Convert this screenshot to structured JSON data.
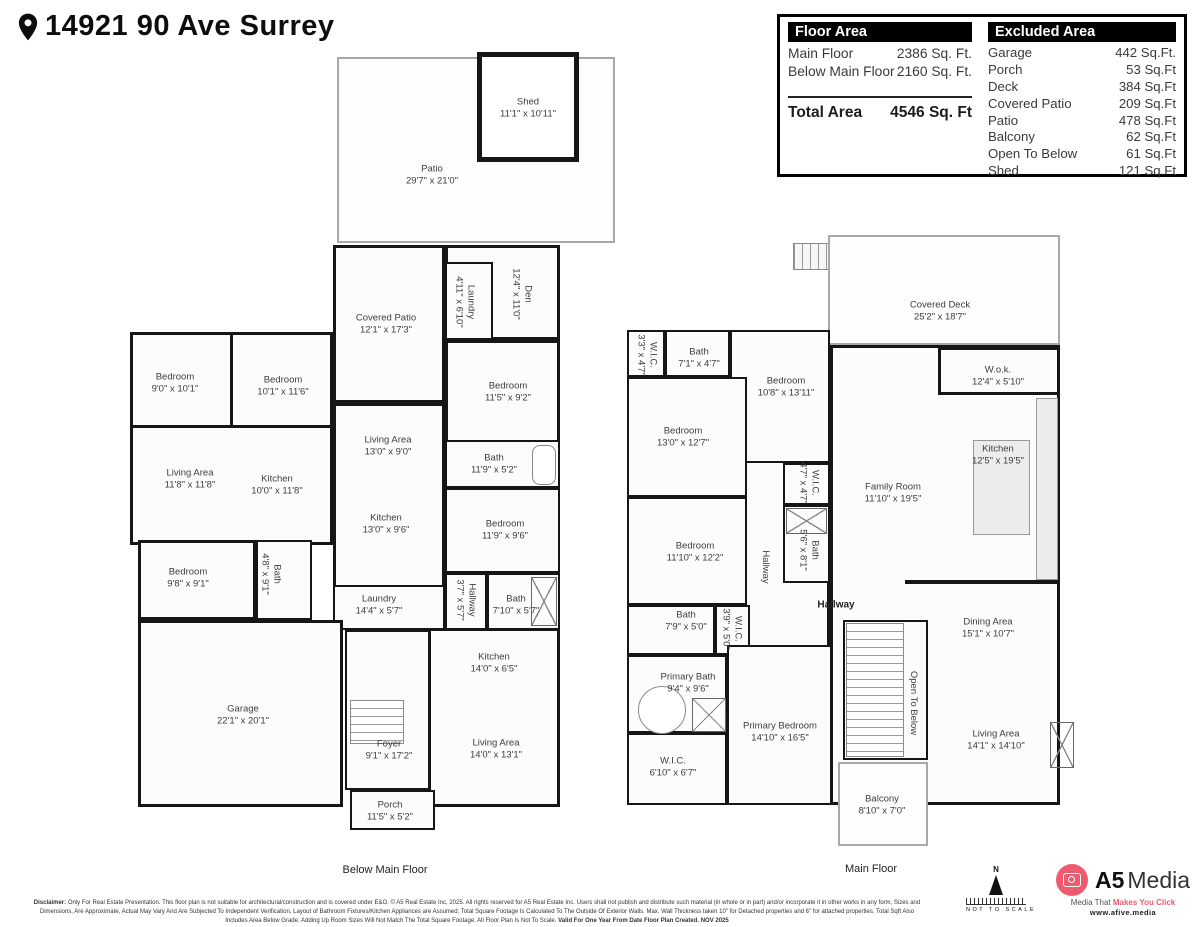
{
  "header": {
    "title": "14921 90 Ave Surrey"
  },
  "floor_area_table": {
    "title": "Floor Area",
    "rows": [
      {
        "label": "Main Floor",
        "value": "2386 Sq. Ft."
      },
      {
        "label": "Below Main Floor",
        "value": "2160 Sq. Ft."
      }
    ],
    "total_label": "Total Area",
    "total_value": "4546 Sq. Ft"
  },
  "excluded_area_table": {
    "title": "Excluded Area",
    "rows": [
      {
        "label": "Garage",
        "value": "442 Sq.Ft."
      },
      {
        "label": "Porch",
        "value": "53 Sq.Ft"
      },
      {
        "label": "Deck",
        "value": "384 Sq.Ft"
      },
      {
        "label": "Covered Patio",
        "value": "209 Sq.Ft"
      },
      {
        "label": "Patio",
        "value": "478 Sq.Ft"
      },
      {
        "label": "Balcony",
        "value": "62 Sq.Ft"
      },
      {
        "label": "Open To Below",
        "value": "61 Sq.Ft"
      },
      {
        "label": "Shed",
        "value": "121 Sq.Ft"
      }
    ]
  },
  "plans": {
    "below": {
      "caption": "Below Main Floor",
      "rooms": [
        {
          "name": "Shed",
          "dims": "11'1\" x 10'11\""
        },
        {
          "name": "Patio",
          "dims": "29'7\" x 21'0\""
        },
        {
          "name": "Covered Patio",
          "dims": "12'1\" x 17'3\""
        },
        {
          "name": "Laundry",
          "dims": "4'11\" x 6'10\""
        },
        {
          "name": "Den",
          "dims": "12'4\" x 11'0\""
        },
        {
          "name": "Bedroom",
          "dims": "9'0\" x 10'1\""
        },
        {
          "name": "Bedroom",
          "dims": "10'1\" x 11'6\""
        },
        {
          "name": "Bedroom",
          "dims": "11'5\" x 9'2\""
        },
        {
          "name": "Living Area",
          "dims": "13'0\" x 9'0\""
        },
        {
          "name": "Bath",
          "dims": "11'9\" x 5'2\""
        },
        {
          "name": "Living Area",
          "dims": "11'8\" x 11'8\""
        },
        {
          "name": "Kitchen",
          "dims": "10'0\" x 11'8\""
        },
        {
          "name": "Kitchen",
          "dims": "13'0\" x 9'6\""
        },
        {
          "name": "Bedroom",
          "dims": "11'9\" x 9'6\""
        },
        {
          "name": "Bedroom",
          "dims": "9'8\" x 9'1\""
        },
        {
          "name": "Bath",
          "dims": "4'8\" x 9'1\""
        },
        {
          "name": "Laundry",
          "dims": "14'4\" x 5'7\""
        },
        {
          "name": "Hallway",
          "dims": "3'7\" x 5'7\""
        },
        {
          "name": "Bath",
          "dims": "7'10\" x 5'7\""
        },
        {
          "name": "Kitchen",
          "dims": "14'0\" x 6'5\""
        },
        {
          "name": "Garage",
          "dims": "22'1\" x 20'1\""
        },
        {
          "name": "Foyer",
          "dims": "9'1\" x 17'2\""
        },
        {
          "name": "Living Area",
          "dims": "14'0\" x 13'1\""
        },
        {
          "name": "Porch",
          "dims": "11'5\" x 5'2\""
        }
      ]
    },
    "main": {
      "caption": "Main Floor",
      "rooms": [
        {
          "name": "Covered Deck",
          "dims": "25'2\" x 18'7\""
        },
        {
          "name": "W.I.C.",
          "dims": "3'3\" x 4'7\""
        },
        {
          "name": "Bath",
          "dims": "7'1\" x 4'7\""
        },
        {
          "name": "Bedroom",
          "dims": "10'8\" x 13'11\""
        },
        {
          "name": "W.o.k.",
          "dims": "12'4\" x 5'10\""
        },
        {
          "name": "Bedroom",
          "dims": "13'0\" x 12'7\""
        },
        {
          "name": "Kitchen",
          "dims": "12'5\" x 19'5\""
        },
        {
          "name": "Family Room",
          "dims": "11'10\" x 19'5\""
        },
        {
          "name": "W.I.C.",
          "dims": "4'7\" x 4'7\""
        },
        {
          "name": "Bath",
          "dims": "5'6\" x 8'1\""
        },
        {
          "name": "Bedroom",
          "dims": "11'10\" x 12'2\""
        },
        {
          "name": "Hallway",
          "dims": ""
        },
        {
          "name": "Hallway",
          "dims": ""
        },
        {
          "name": "Bath",
          "dims": "7'9\" x 5'0\""
        },
        {
          "name": "W.I.C.",
          "dims": "3'9\" x 5'0\""
        },
        {
          "name": "Dining Area",
          "dims": "15'1\" x 10'7\""
        },
        {
          "name": "Primary Bath",
          "dims": "9'4\" x 9'6\""
        },
        {
          "name": "Open To Below",
          "dims": ""
        },
        {
          "name": "Primary Bedroom",
          "dims": "14'10\" x 16'5\""
        },
        {
          "name": "Living Area",
          "dims": "14'1\" x 14'10\""
        },
        {
          "name": "W.I.C.",
          "dims": "6'10\" x 6'7\""
        },
        {
          "name": "Balcony",
          "dims": "8'10\" x 7'0\""
        }
      ]
    }
  },
  "footer": {
    "disclaimer": {
      "label": "Disclaimer:",
      "line1": "Only For Real Estate Presentation. This floor plan is not suitable for architectural/construction and is covered under E&O. © A5 Real Estate Inc, 2025. All rights reserved for A5 Real Estate Inc. Users shall not publish and distribute such material (in whole or in part) and/or incorporate it in other works in any form, Sizes and Dimensions, Are Approximate, Actual May Vary And Are Subjected To Independent Verification, Layout of Bathroom Fixtures/Kitchen",
      "line2": "Appliances are Assumed; Total Square Footage Is Calculated To The Outside Of Exterior Walls. Max. Wall Thickness taken 10\" for Detached properties and 6\" for attached properties. Total Sqft Also Includes Area Below Grade. Adding Up Room Sizes Will Not Match The Total Square Footage. All Floor Plan Is Not To Scale.",
      "line2_bold": "Valid For One Year From Date Floor Plan Created. NOV 2025"
    },
    "compass": {
      "north": "N",
      "note": "NOT TO SCALE"
    },
    "logo": {
      "brand_bold": "A5",
      "brand_light": "Media",
      "tagline_prefix": "Media That ",
      "tagline_accent": "Makes You Click",
      "website": "www.afive.media"
    },
    "accent_pink": "#ef5a6e"
  }
}
